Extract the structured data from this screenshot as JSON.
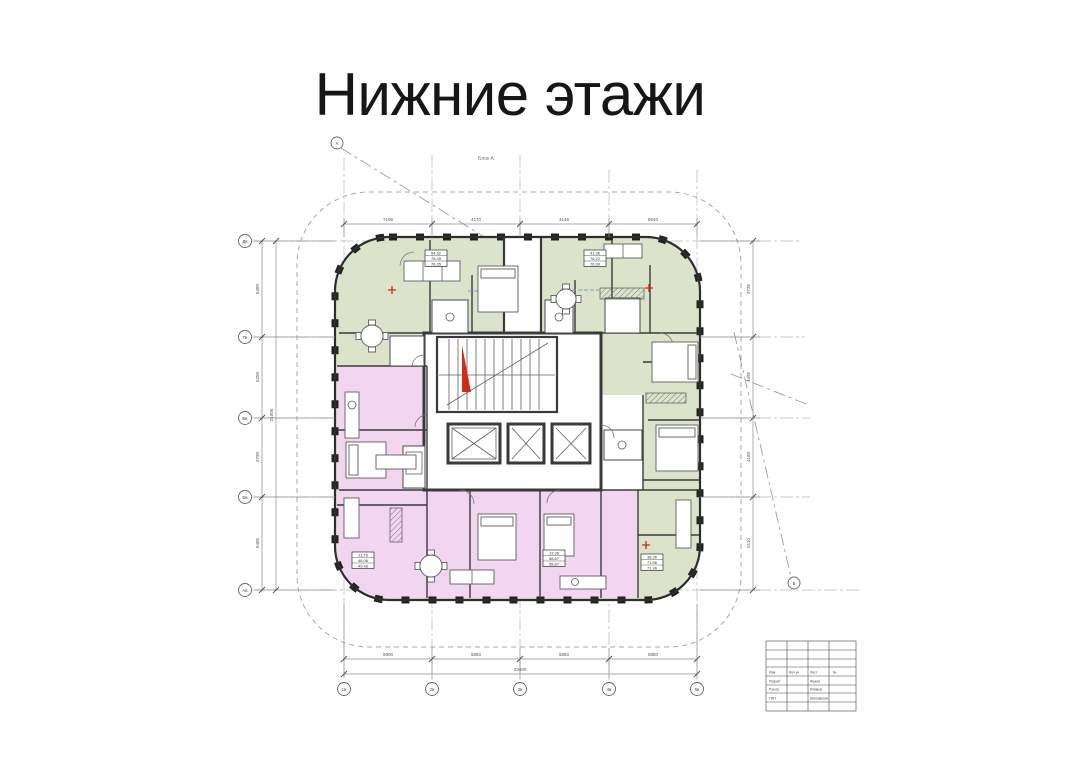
{
  "page": {
    "title": "Нижние этажи"
  },
  "plan": {
    "block_label": "Блок А",
    "colors": {
      "apartments_green": "#dbe4cb",
      "apartments_pink": "#f2d6ef",
      "walls": "#333333",
      "accent_red": "#c92c18",
      "grid_lines": "#b9b9b9"
    },
    "axes": {
      "left": [
        "Дв",
        "Гв",
        "Вв",
        "Бв",
        "Ав"
      ],
      "bottom": [
        "1в",
        "2в",
        "3в",
        "4в",
        "5в"
      ],
      "top_diagonal": "А",
      "right_diagonal": "Б"
    },
    "dims": {
      "top": [
        "7195",
        "4170",
        "3145",
        "8640"
      ],
      "bottom": [
        "5900",
        "5850",
        "5850",
        "5880"
      ],
      "bottom_total": "23480",
      "left": [
        "6480",
        "5250",
        "2790",
        "6485"
      ],
      "left_total": "21005",
      "right": [
        "3735",
        "4495",
        "4160",
        "5110"
      ]
    },
    "stamps": [
      {
        "r1": "64.32",
        "r2": "76.35",
        "r3": "76.35"
      },
      {
        "r1": "41.36",
        "r2": "76.22",
        "r3": "76.30"
      },
      {
        "r1": "11.76",
        "r2": "46.06",
        "r3": "49.46"
      },
      {
        "r1": "13.36",
        "r2": "58.67",
        "r3": "58.87"
      },
      {
        "r1": "38.36",
        "r2": "71.96",
        "r3": "71.96"
      }
    ],
    "titleblock": {
      "c1": "Изм",
      "c2": "Кол.уч",
      "c3": "Лист",
      "c4": "№",
      "r2l": "Разраб",
      "r2r": "Жуков",
      "r3l": "Рук.пр.",
      "r3r": "Климов",
      "r4l": "ГИП",
      "r4r": "Шаповалов"
    }
  }
}
